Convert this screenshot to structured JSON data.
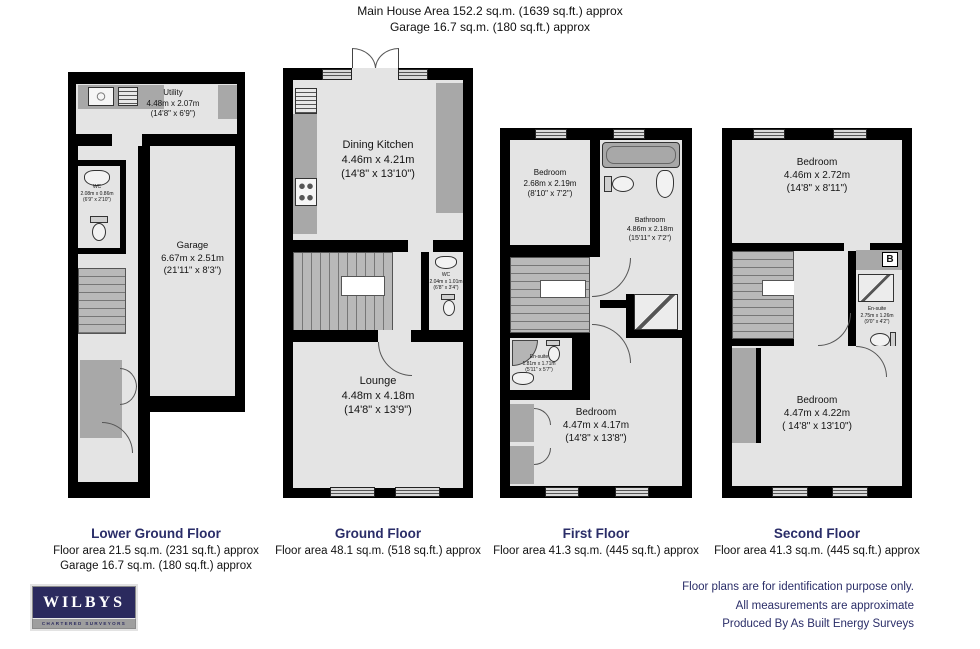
{
  "header": {
    "line1": "Main House Area 152.2 sq.m. (1639 sq.ft.) approx",
    "line2": "Garage 16.7 sq.m. (180 sq.ft.) approx"
  },
  "floors": [
    {
      "title": "Lower Ground Floor",
      "area1": "Floor area 21.5 sq.m. (231 sq.ft.) approx",
      "area2": "Garage 16.7 sq.m. (180 sq.ft.) approx",
      "rooms": [
        {
          "name": "Utility",
          "metric": "4.48m x 2.07m",
          "imperial": "(14'8\" x 6'9\")"
        },
        {
          "name": "WC",
          "metric": "2.08m x 0.86m",
          "imperial": "(6'9\" x 2'10\")"
        },
        {
          "name": "Garage",
          "metric": "6.67m x 2.51m",
          "imperial": "(21'11\" x 8'3\")"
        }
      ]
    },
    {
      "title": "Ground Floor",
      "area1": "Floor area 48.1 sq.m. (518 sq.ft.) approx",
      "rooms": [
        {
          "name": "Dining Kitchen",
          "metric": "4.46m x 4.21m",
          "imperial": "(14'8\" x 13'10\")"
        },
        {
          "name": "WC",
          "metric": "2.04m x 1.01m",
          "imperial": "(6'8\" x 3'4\")"
        },
        {
          "name": "Lounge",
          "metric": "4.48m x 4.18m",
          "imperial": "(14'8\" x 13'9\")"
        }
      ]
    },
    {
      "title": "First Floor",
      "area1": "Floor area 41.3 sq.m. (445 sq.ft.) approx",
      "rooms": [
        {
          "name": "Bedroom",
          "metric": "2.68m x 2.19m",
          "imperial": "(8'10\" x 7'2\")"
        },
        {
          "name": "Bathroom",
          "metric": "4.86m x 2.18m",
          "imperial": "(15'11\" x 7'2\")"
        },
        {
          "name": "En-suite",
          "metric": "1.81m x 1.71m",
          "imperial": "(5'11\" x 5'7\")"
        },
        {
          "name": "Bedroom",
          "metric": "4.47m x 4.17m",
          "imperial": "(14'8\" x 13'8\")"
        }
      ]
    },
    {
      "title": "Second Floor",
      "area1": "Floor area 41.3 sq.m. (445 sq.ft.) approx",
      "boiler": "B",
      "rooms": [
        {
          "name": "Bedroom",
          "metric": "4.46m x 2.72m",
          "imperial": "(14'8\" x 8'11\")"
        },
        {
          "name": "En-suite",
          "metric": "2.75m x 1.26m",
          "imperial": "(9'0\" x 4'2\")"
        },
        {
          "name": "Bedroom",
          "metric": "4.47m x 4.22m",
          "imperial": "( 14'8\" x 13'10\")"
        }
      ]
    }
  ],
  "footer": {
    "line1": "Floor plans are for identification purpose only.",
    "line2": "All measurements are approximate",
    "line3": "Produced By As Built Energy Surveys"
  },
  "logo": {
    "name": "WILBYS",
    "tagline": "CHARTERED SURVEYORS"
  }
}
